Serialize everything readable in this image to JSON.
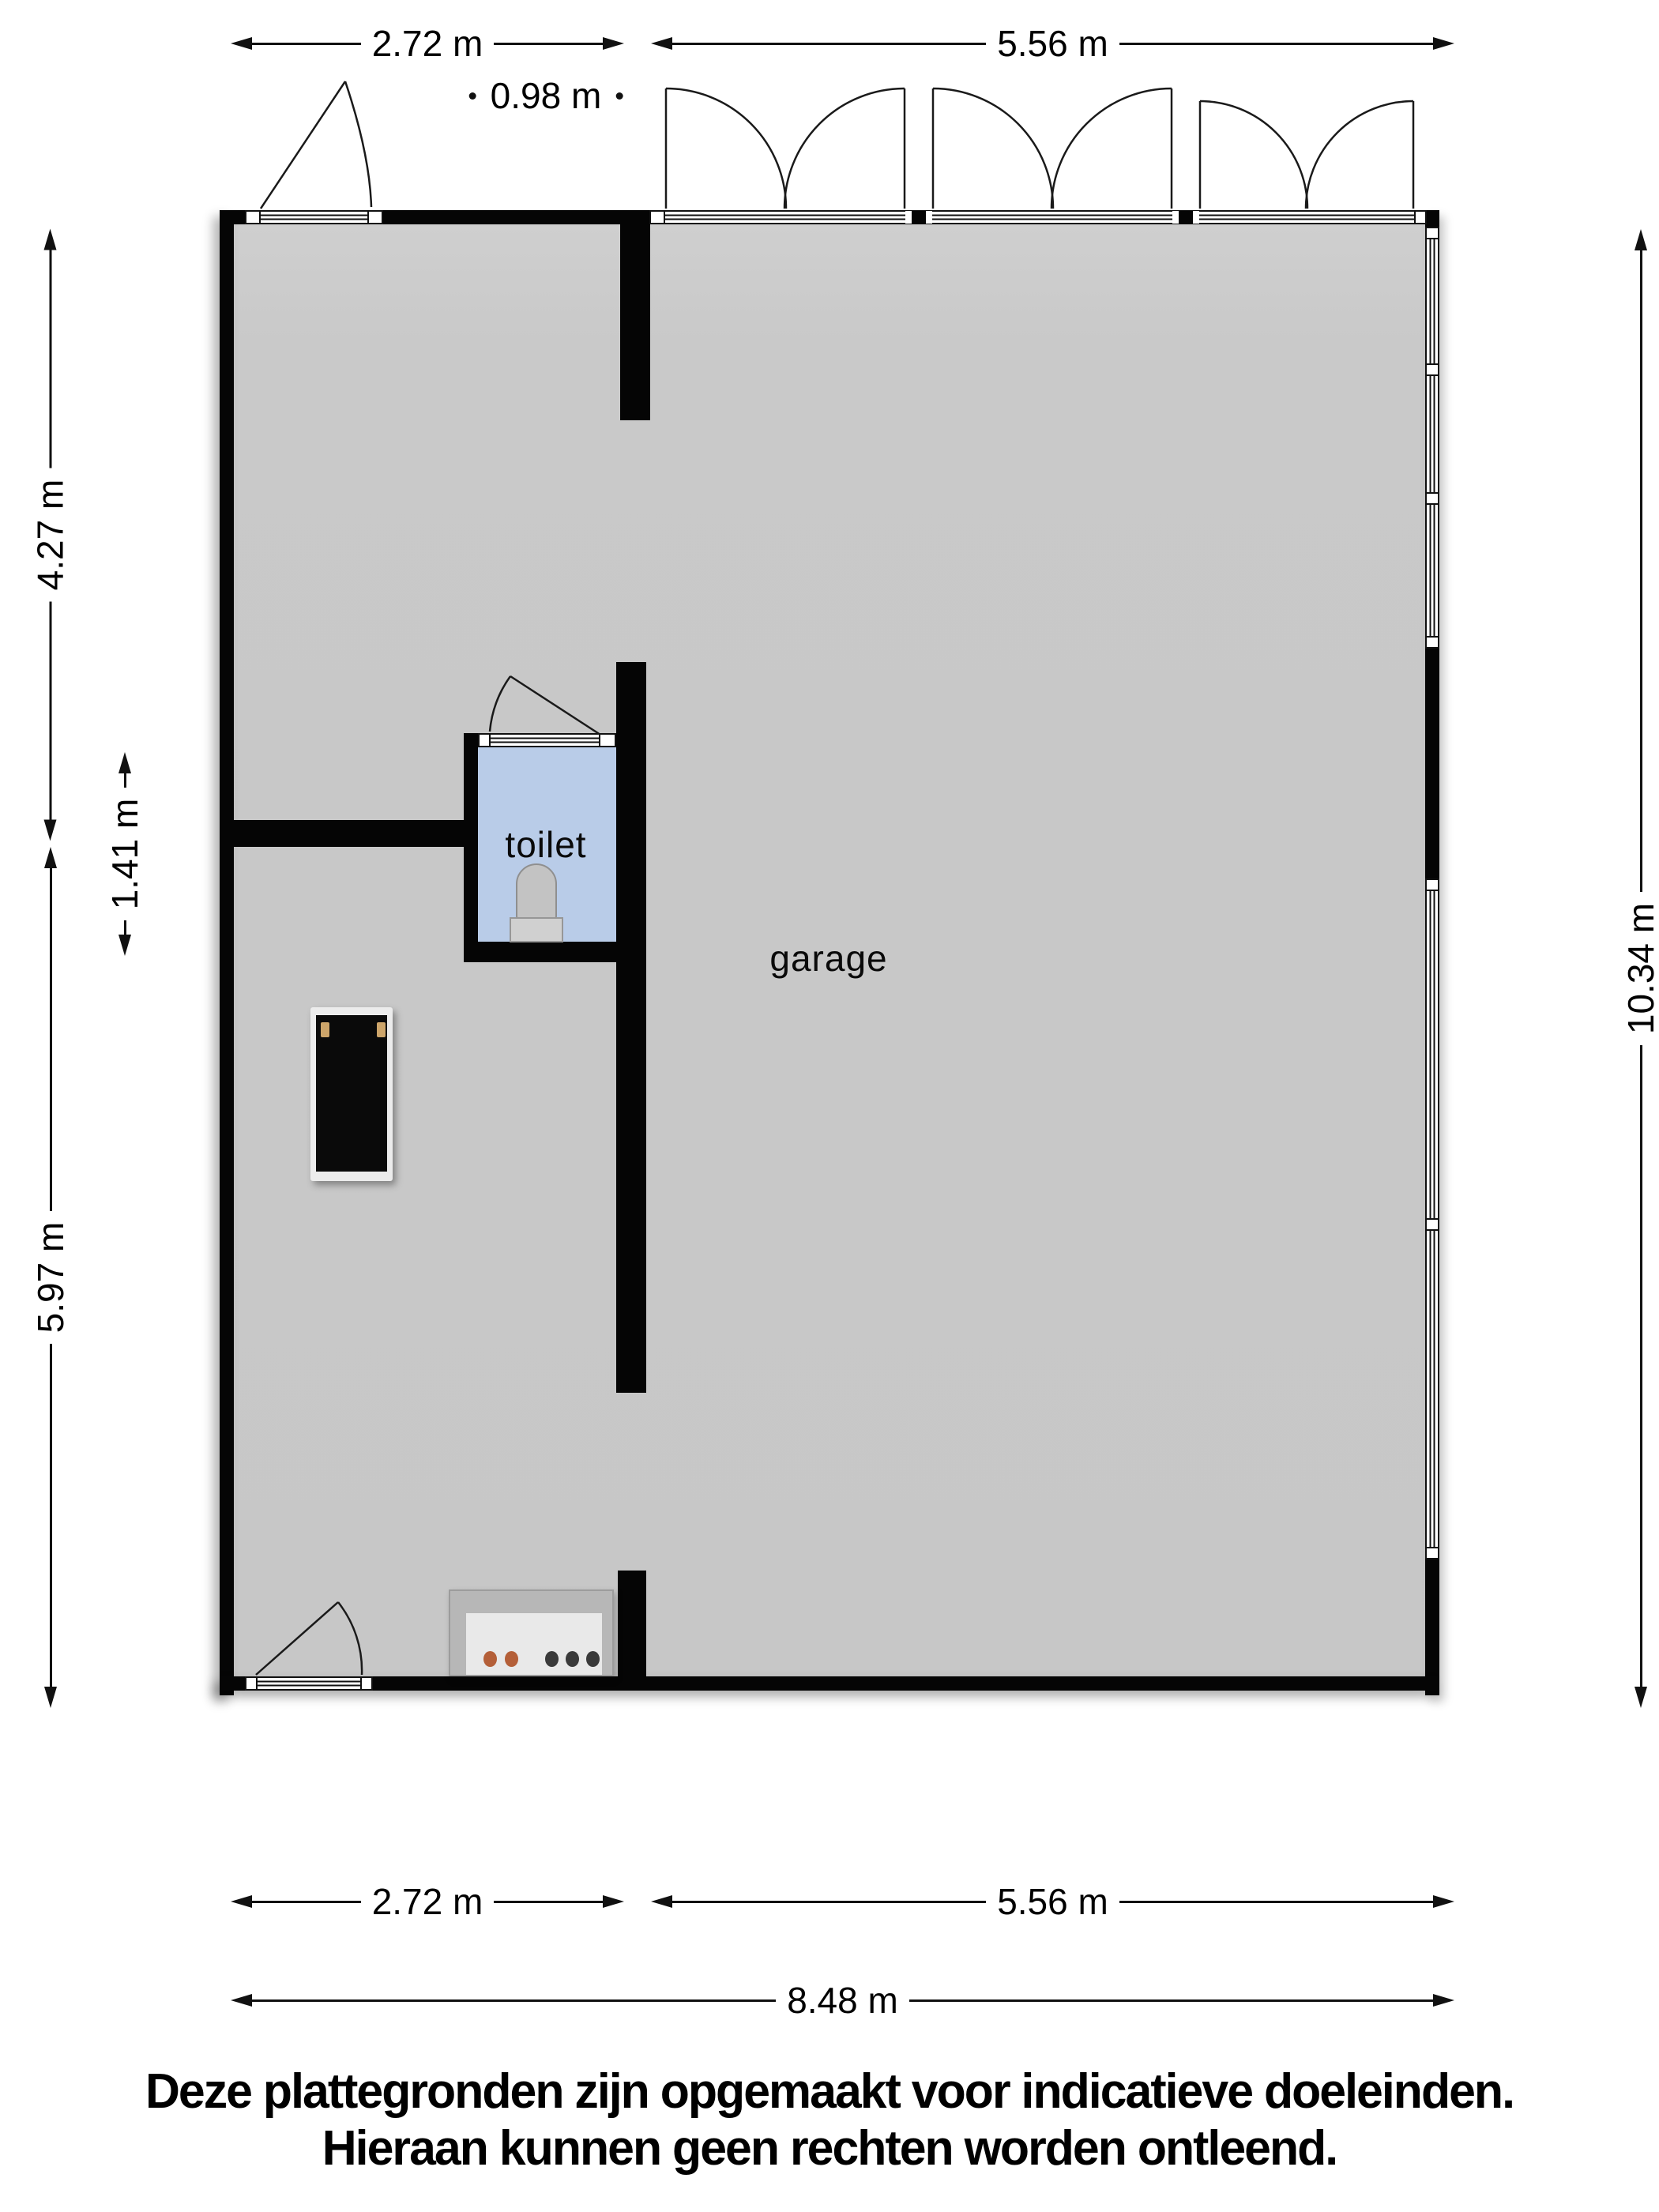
{
  "plan": {
    "type": "floor-plan",
    "rooms": {
      "toilet": "toilet",
      "garage": "garage"
    }
  },
  "dimensions": {
    "top": {
      "left_section": "2.72 m",
      "door": "0.98 m",
      "right_section": "5.56 m"
    },
    "left": {
      "upper": "4.27 m",
      "middle": "1.41 m",
      "lower": "5.97 m"
    },
    "right": {
      "total": "10.34 m"
    },
    "bottom": {
      "left_section": "2.72 m",
      "right_section": "5.56 m",
      "total": "8.48 m"
    }
  },
  "disclaimer": {
    "line1": "Deze plattegronden zijn opgemaakt voor indicatieve doeleinden.",
    "line2": "Hieraan kunnen geen rechten worden ontleend."
  },
  "colors": {
    "wall": "#050505",
    "floor": "#c8c8c8",
    "toilet_floor": "#b9cce8",
    "fixture_gray": "#c3c3c3",
    "knob_orange": "#b45f38",
    "knob_dark": "#3a3a3a",
    "handle_tan": "#cda56a"
  }
}
